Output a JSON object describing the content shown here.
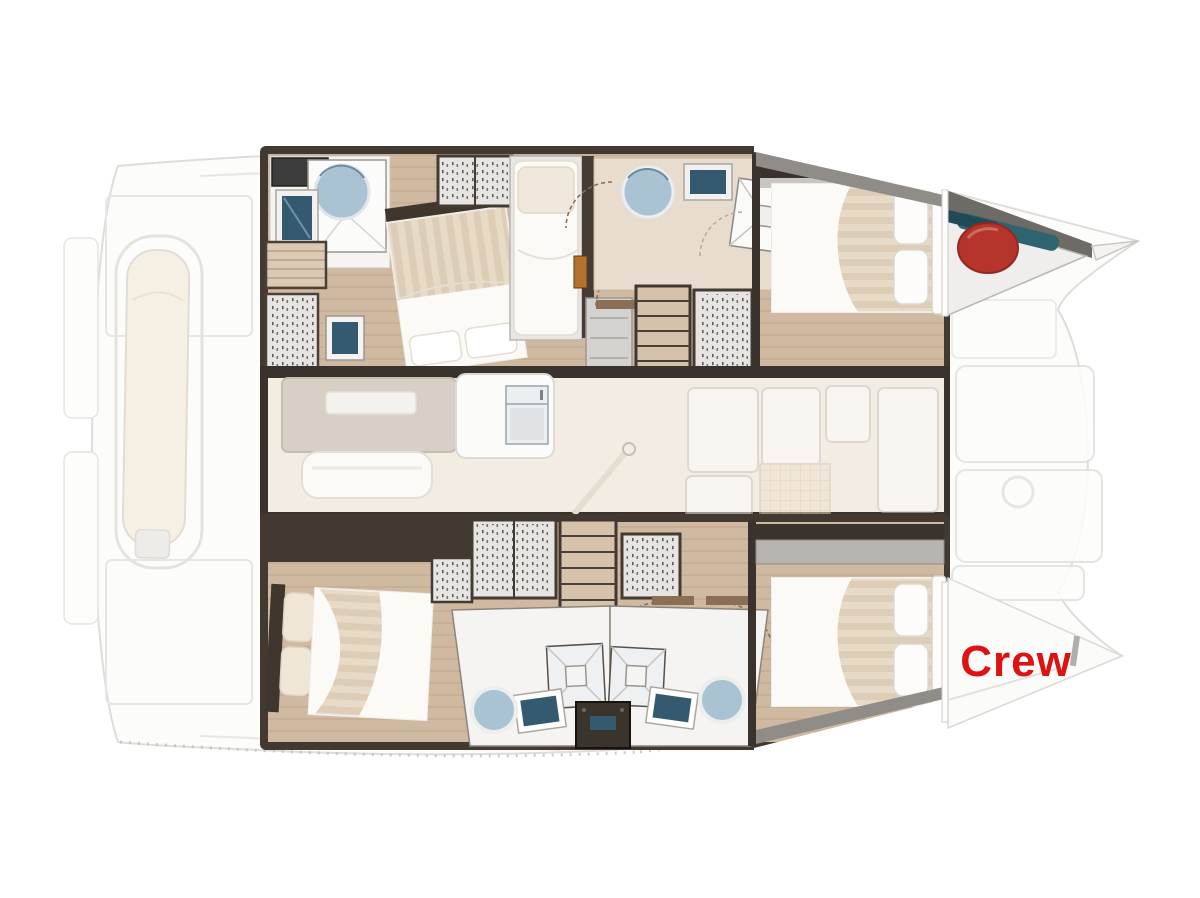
{
  "labels": {
    "crew": "Crew"
  },
  "colors": {
    "crew-red": "#dd1212",
    "fender-red": "#b5352c",
    "gear-teal": "#2d6470",
    "wall-dark": "#423a31",
    "floor-wood": "#d0b9a1",
    "saloon-floor": "#f2ece3",
    "bathroom-white": "#f5f4f2",
    "sink-blue": "#35596e",
    "shower-glass": "#a9c3d2",
    "mattress-beige": "#e7dac7",
    "linen-white": "#fbfaf7",
    "wardrobe-gray": "#e6e5e3",
    "counter-gray": "#d8d0c6",
    "stair-wood": "#d6c2aa",
    "door-brown": "#8a6f55",
    "jamb-orange": "#b5722f",
    "shelf-gray": "#b7b3ae",
    "tech-dark": "#3a342d",
    "deck-gray": "#908d89",
    "faded-stroke": "#dcdad6"
  },
  "diagram": {
    "type": "catamaran-interior-floor-plan",
    "features": [
      "aft-deck",
      "transom-steps",
      "tender-dinghy",
      "port-aft-bathroom",
      "round-shower",
      "port-aft-cabin-double-bed",
      "single-berth",
      "companionway-stairs",
      "port-fwd-bathroom",
      "port-fwd-cabin-double-bed",
      "anchor-locker",
      "red-fender",
      "teal-deck-gear",
      "saloon-galley",
      "fridge",
      "sofa",
      "dinette-table",
      "cockpit-door",
      "stbd-aft-cabin-double-bed",
      "wardrobes",
      "twin-mid-bathrooms",
      "shower-stalls",
      "toilets",
      "sinks",
      "technical-box",
      "crew-cabin-double-bed",
      "foredeck-sunpads",
      "bow-tips"
    ]
  }
}
